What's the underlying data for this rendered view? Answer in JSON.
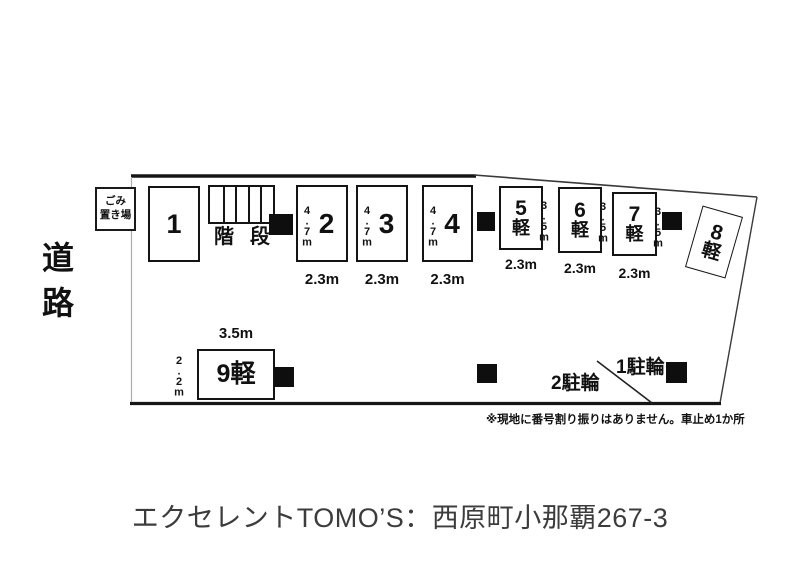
{
  "map": {
    "road_label": "道路",
    "trash_area": {
      "line1": "ごみ",
      "line2": "置き場"
    },
    "stairs_label": "階段",
    "spots": [
      {
        "number": "1"
      },
      {
        "number": "2",
        "depth": "4.7m",
        "width": "2.3m"
      },
      {
        "number": "3",
        "depth": "4.7m",
        "width": "2.3m"
      },
      {
        "number": "4",
        "depth": "4.7m",
        "width": "2.3m"
      },
      {
        "number": "5",
        "kei": "軽",
        "depth": "3.5m",
        "width": "2.3m"
      },
      {
        "number": "6",
        "kei": "軽",
        "depth": "3.5m",
        "width": "2.3m"
      },
      {
        "number": "7",
        "kei": "軽",
        "depth": "3.5m",
        "width": "2.3m"
      },
      {
        "number": "8",
        "kei": "軽"
      },
      {
        "number": "9軽",
        "width_top": "3.5m",
        "depth_left": "2.2m"
      }
    ],
    "bike_parking_1_label": "1駐輪",
    "bike_parking_2_label": "2駐輪",
    "note": "※現地に番号割り振りはありません。車止め1か所"
  },
  "footer": {
    "title": "エクセレントTOMO’S：西原町小那覇267-3"
  }
}
